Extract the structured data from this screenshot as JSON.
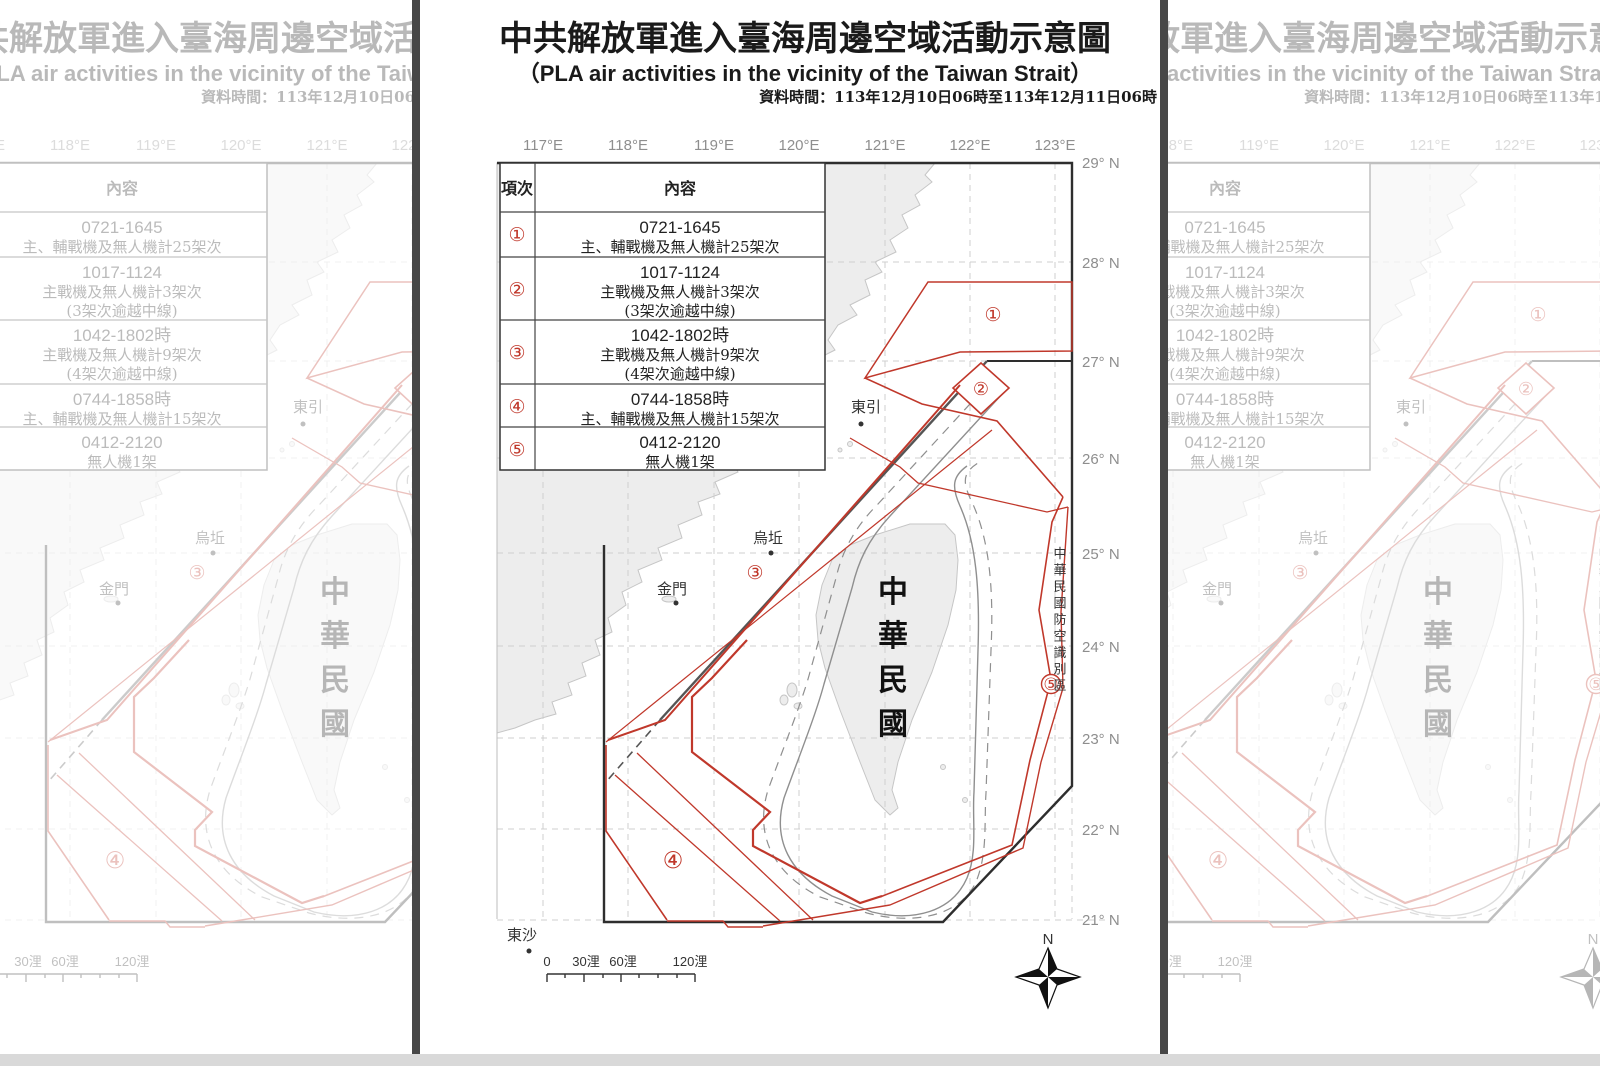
{
  "title_block": {
    "title": "中共解放軍進入臺海周邊空域活動示意圖",
    "subtitle": "（PLA air activities in the vicinity of the Taiwan Strait）",
    "data_time": "資料時間：113年12月10日06時至113年12月11日06時"
  },
  "table": {
    "col_item": "項次",
    "col_content": "內容",
    "rows": [
      {
        "num": "①",
        "lines": [
          "0721-1645",
          "主、輔戰機及無人機計25架次"
        ]
      },
      {
        "num": "②",
        "lines": [
          "1017-1124",
          "主戰機及無人機計3架次",
          "(3架次逾越中線)"
        ]
      },
      {
        "num": "③",
        "lines": [
          "1042-1802時",
          "主戰機及無人機計9架次",
          "(4架次逾越中線)"
        ]
      },
      {
        "num": "④",
        "lines": [
          "0744-1858時",
          "主、輔戰機及無人機計15架次"
        ]
      },
      {
        "num": "⑤",
        "lines": [
          "0412-2120",
          "無人機1架"
        ]
      }
    ]
  },
  "map": {
    "lon_labels": [
      "117°E",
      "118°E",
      "119°E",
      "120°E",
      "121°E",
      "122°E",
      "123°E"
    ],
    "lat_labels": [
      "29° N",
      "28° N",
      "27° N",
      "26° N",
      "25° N",
      "24° N",
      "23° N",
      "22° N",
      "21° N"
    ],
    "markers": [
      "①",
      "②",
      "③",
      "④",
      "⑤"
    ],
    "places": {
      "dongyin": "東引",
      "wuqiu": "烏坵",
      "kinmen": "金門",
      "dongsha": "東沙"
    },
    "island_label": "中華民國",
    "adiz_label": "中華民國防空識別區",
    "compass_north": "N",
    "scale_labels": [
      "0",
      "30浬",
      "60浬",
      "120浬"
    ]
  },
  "colors": {
    "activity_red": "#c0382b",
    "boundary_black": "#2e2e2e",
    "median_gray": "#555555",
    "land_fill": "#ededed",
    "land_stroke": "#c6c6c6",
    "grid_gray": "#cfcfcf",
    "tick_label_gray": "#8e8e8e",
    "contour_gray": "#8f8f8f"
  }
}
